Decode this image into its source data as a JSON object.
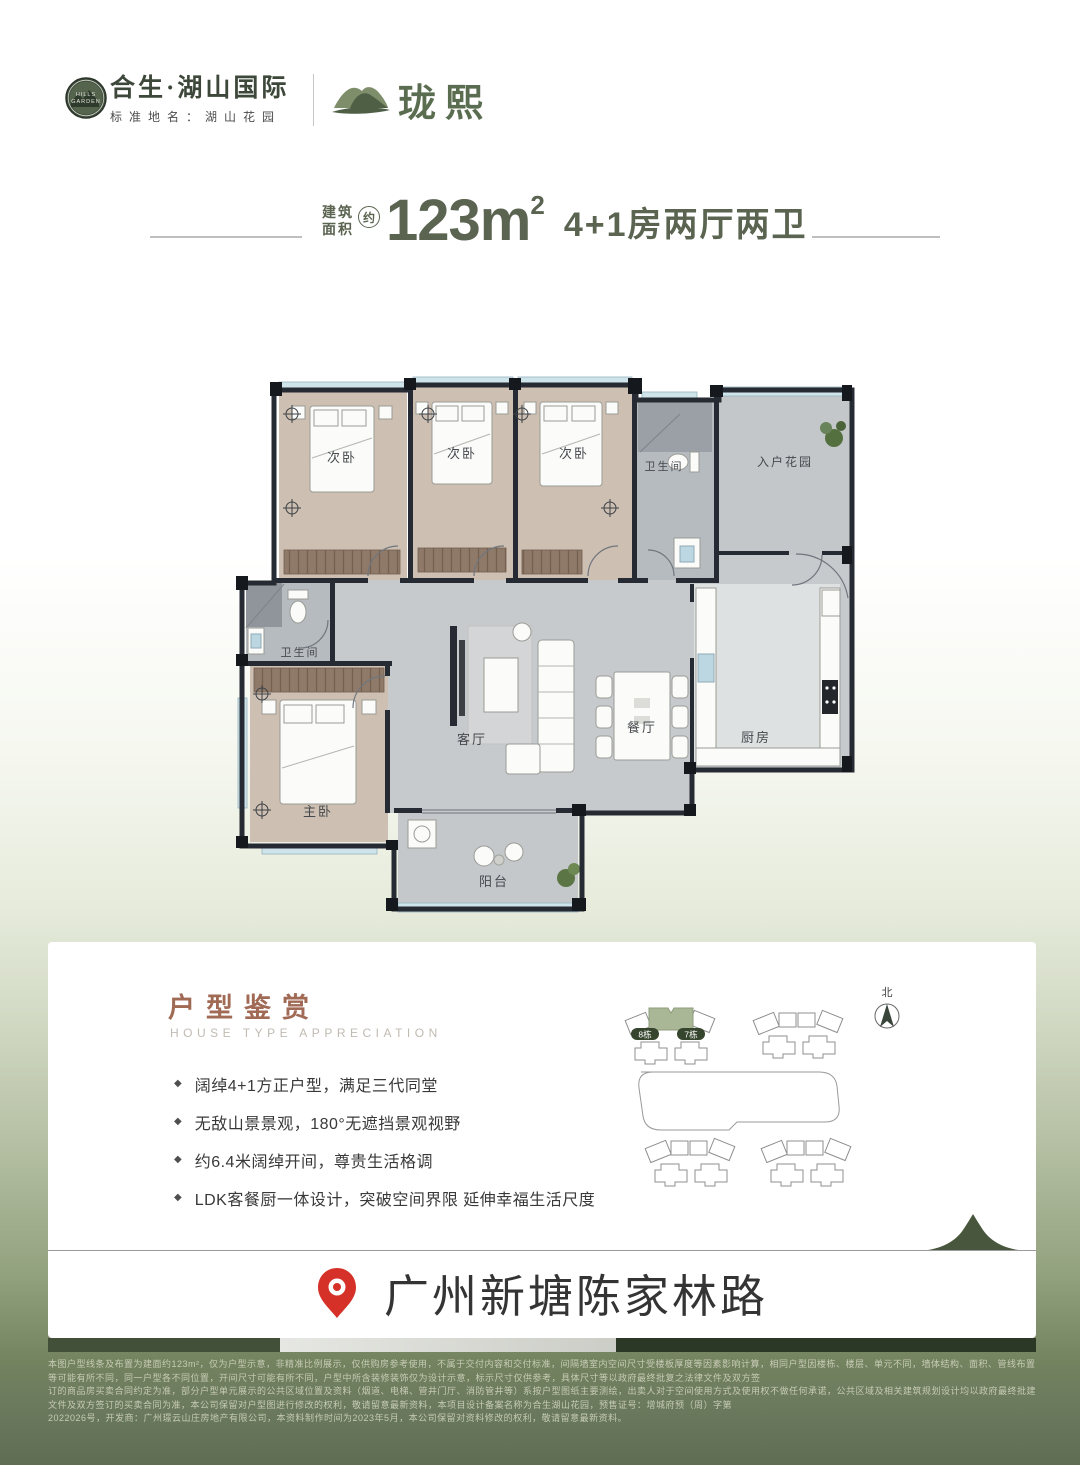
{
  "header": {
    "emblem": {
      "top": "HILLS",
      "bottom": "GARDEN"
    },
    "brand_name": "合生·湖山国际",
    "brand_subtitle": "标准地名：湖山花园",
    "sub_brand": "珑熙"
  },
  "title": {
    "area_label_line1": "建筑",
    "area_label_line2": "面积",
    "approx": "约",
    "area_value": "123m",
    "area_sup": "2",
    "layout": "4+1房两厅两卫"
  },
  "floor_plan": {
    "rooms": {
      "bedroom_a": "次卧",
      "bedroom_b": "次卧",
      "bedroom_c": "次卧",
      "bath_top": "卫生间",
      "entry_garden": "入户花园",
      "bath_left": "卫生间",
      "master": "主卧",
      "living": "客厅",
      "dining": "餐厅",
      "kitchen": "厨房",
      "balcony": "阳台"
    }
  },
  "appreciation": {
    "title": "户型鉴赏",
    "subtitle": "HOUSE TYPE APPRECIATION",
    "bullet_marker": "◆",
    "bullets": [
      "阔绰4+1方正户型，满足三代同堂",
      "无敌山景景观，180°无遮挡景观视野",
      "约6.4米阔绰开间，尊贵生活格调",
      "LDK客餐厨一体设计，突破空间界限 延伸幸福生活尺度"
    ]
  },
  "site_plan": {
    "north_label": "北",
    "building_labels": [
      "8栋",
      "7栋"
    ]
  },
  "location": {
    "address": "广州新塘陈家林路"
  },
  "disclaimer": {
    "lines": [
      "本图户型线条及布置为建面约123m²，仅为户型示意，非精准比例展示，仅供购房参考使用，不属于交付内容和交付标准，间隔墙室内空间尺寸受楼板厚度等因素影响计算，相同户型因楼栋、楼层、单元不同，墙体结构、面积、管线布置等可能有所不同，同一户型各不同位置，开间尺寸可能有所不同，户型中所含装修装饰仅为设计示意，标示尺寸仅供参考，具体尺寸等以政府最终批复之法律文件及双方签",
      "订的商品房买卖合同约定为准，部分户型单元展示的公共区域位置及资料（烟道、电梯、管井门厅、消防管井等）系按户型图纸主要测绘，出卖人对于空间使用方式及使用权不做任何承诺，公共区域及相关建筑规划设计均以政府最终批建文件及双方签订的买卖合同为准，本公司保留对户型图进行修改的权利，敬请留意最新资料，本项目设计备案名称为合生湖山花园，预售证号：增城府预（周）字第",
      "2022026号，开发商：广州璟云山庄房地产有限公司，本资料制作时间为2023年5月，本公司保留对资料修改的权利，敬请留意最新资料。"
    ]
  },
  "colors": {
    "brand_green": "#3d483a",
    "title_green": "#5a6450",
    "copper": "#a06a55",
    "pin_red": "#d53128",
    "site_highlight": "#a9b797",
    "olive_background": "#68775c"
  }
}
